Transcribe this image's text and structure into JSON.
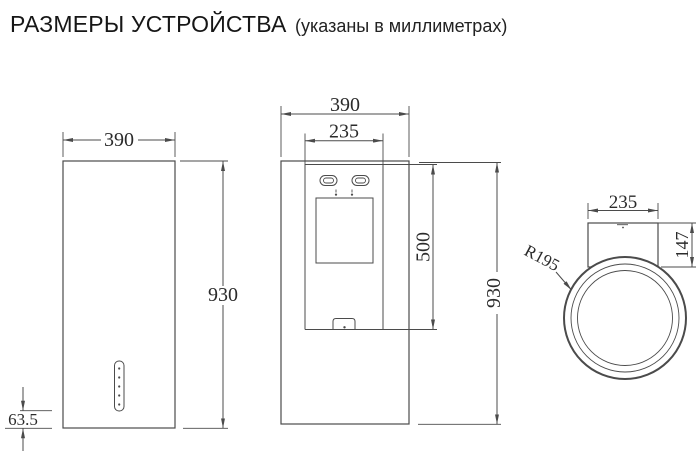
{
  "title": {
    "main": "РАЗМЕРЫ УСТРОЙСТВА",
    "sub": "(указаны в миллиметрах)"
  },
  "views": {
    "side": {
      "width_label": "390",
      "height_label": "930",
      "control_offset_label": "63.5"
    },
    "front": {
      "width_label": "390",
      "glass_width_label": "235",
      "glass_height_label": "500",
      "height_label": "930"
    },
    "top": {
      "body_width_label": "235",
      "depth_label": "147",
      "radius_label": "R195"
    }
  },
  "colors": {
    "line": "#4b4b4b",
    "text": "#2b2b2b",
    "background": "#ffffff"
  }
}
